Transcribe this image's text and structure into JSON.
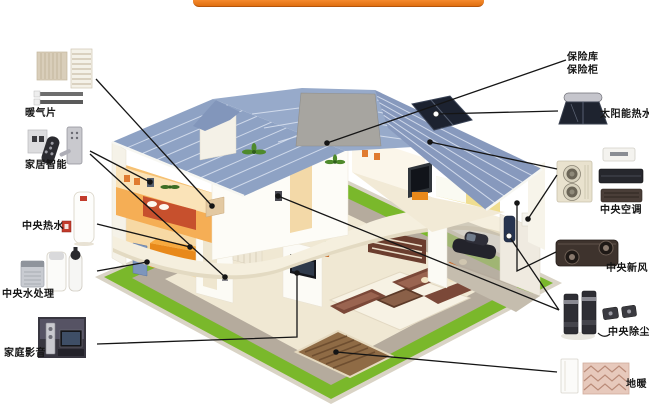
{
  "banner": {
    "color": "#ee7a1e"
  },
  "legend": {
    "left": [
      {
        "id": "radiator",
        "label": "暖气片",
        "icon": "radiator-icon"
      },
      {
        "id": "smart-home",
        "label": "家居智能",
        "icon": "smart-lock-icon"
      },
      {
        "id": "central-hot-water",
        "label": "中央热水",
        "icon": "water-heater-icon"
      },
      {
        "id": "central-water-treatment",
        "label": "中央水处理",
        "icon": "water-purifier-icon"
      },
      {
        "id": "home-theater",
        "label": "家庭影音",
        "icon": "home-theater-icon"
      }
    ],
    "right": [
      {
        "id": "safe",
        "label_line1": "保险库",
        "label_line2": "保险柜",
        "icon": "safe-icon"
      },
      {
        "id": "solar-hot-water",
        "label": "太阳能热水",
        "icon": "solar-heater-icon"
      },
      {
        "id": "central-ac",
        "label": "中央空调",
        "icon": "ac-outdoor-unit-icon"
      },
      {
        "id": "central-fresh-air",
        "label": "中央新风",
        "icon": "ventilation-unit-icon"
      },
      {
        "id": "central-vacuum",
        "label": "中央除尘",
        "icon": "vacuum-unit-icon"
      },
      {
        "id": "floor-heating",
        "label": "地暖",
        "icon": "floor-heating-coil-icon"
      }
    ]
  },
  "colors": {
    "banner_orange": "#ee7a1e",
    "roof_blue": "#8ea2c4",
    "grass_green": "#7ab82b",
    "callout_line": "#151515"
  }
}
